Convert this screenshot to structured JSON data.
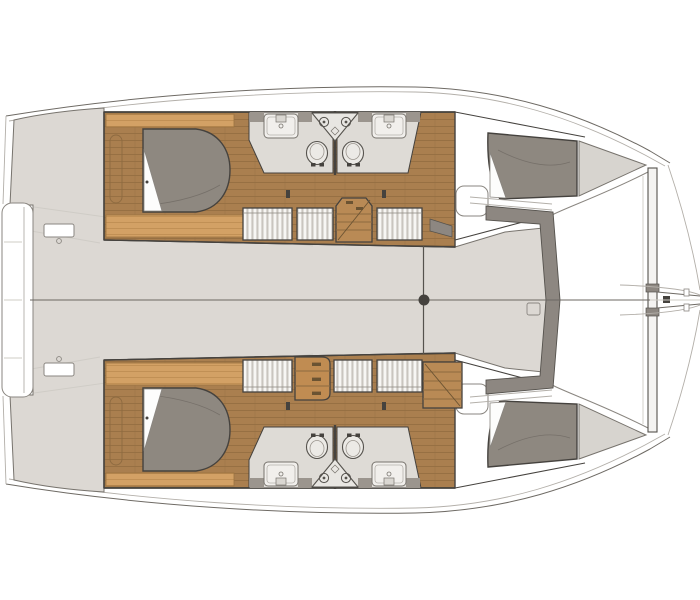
{
  "meta": {
    "title": "Catamaran interior layout floor plan",
    "view": "top-down deck/accommodation plan",
    "bow_direction": "right",
    "cabins": 4,
    "bathrooms": 4
  },
  "colors": {
    "background": "#ffffff",
    "outline": "#45423e",
    "outline_soft": "#6e6a64",
    "line_faint": "#c9c5bf",
    "deck": "#dcd8d3",
    "deck_dark_band": "#8d8781",
    "wood": "#aa7f4f",
    "wood_line": "#916b3f",
    "wood_light": "#d3a165",
    "wood_mid": "#b98a55",
    "mattress": "#8e8880",
    "sheet": "#fdfdfc",
    "bath_floor": "#dedbd6",
    "fixture": "#f1efec",
    "counter": "#9b958e",
    "storage": "#d7d4cf",
    "hanger_bg": "#f7f6f4",
    "hanger_stripe": "#c9c5bf",
    "beam": "#f4f3f1"
  },
  "layout": {
    "center_features": [
      "stern-swim-platform",
      "bridgedeck-saloon",
      "centerline",
      "mast-step",
      "forward-cockpit-seats",
      "trampoline",
      "forward-crossbeam",
      "bowsprit-bridle"
    ],
    "hull_top": {
      "rooms": [
        {
          "name": "aft-cabin",
          "furniture": [
            "double-bed",
            "bed-platform",
            "locker"
          ]
        },
        {
          "name": "aft-bathroom",
          "furniture": [
            "shower",
            "toilet",
            "vanity-sinks"
          ]
        },
        {
          "name": "forward-bathroom",
          "furniture": [
            "shower",
            "toilet",
            "vanity-sinks"
          ]
        },
        {
          "name": "passageway",
          "furniture": [
            "wardrobe",
            "wardrobe",
            "staircase",
            "wardrobe"
          ]
        },
        {
          "name": "forward-cabin",
          "furniture": [
            "double-bed",
            "bench",
            "bow-storage"
          ]
        }
      ]
    },
    "hull_bottom": {
      "rooms": [
        {
          "name": "aft-cabin",
          "furniture": [
            "double-bed",
            "bed-platform",
            "locker"
          ]
        },
        {
          "name": "aft-bathroom",
          "furniture": [
            "shower",
            "toilet",
            "vanity-sinks"
          ]
        },
        {
          "name": "forward-bathroom",
          "furniture": [
            "shower",
            "toilet",
            "vanity-sinks"
          ]
        },
        {
          "name": "passageway",
          "furniture": [
            "wardrobe",
            "dresser-3-drawers",
            "wardrobe",
            "wardrobe",
            "staircase"
          ]
        },
        {
          "name": "forward-cabin",
          "furniture": [
            "double-bed",
            "bench",
            "bow-storage"
          ]
        }
      ]
    }
  }
}
